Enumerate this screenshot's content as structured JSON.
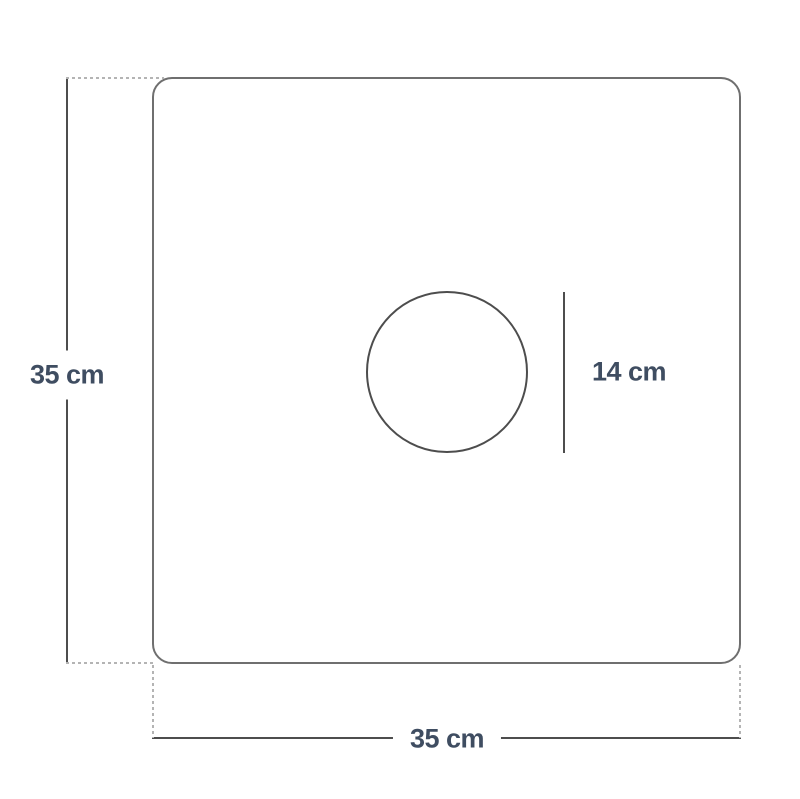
{
  "diagram": {
    "height_label": "35 cm",
    "width_label": "35 cm",
    "hole_diameter_label": "14 cm"
  },
  "colors": {
    "background": "#ffffff",
    "panel_outline": "#6f6f6f",
    "dimension_line": "#4d4d4d",
    "extension_line": "#b4b4b4",
    "label_text": "#3f4d61"
  }
}
